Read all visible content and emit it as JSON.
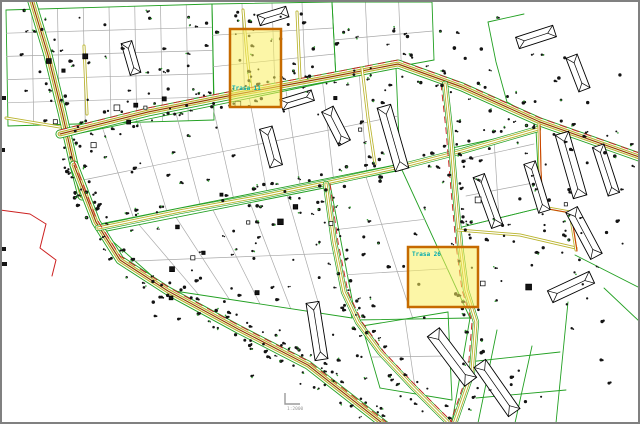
{
  "app": {
    "type": "cad-map-viewport",
    "description": "Cadastral / urban plan drawing with parcels, streets, buildings and tree symbols"
  },
  "map": {
    "highlights": [
      {
        "label": "Trasa 11"
      },
      {
        "label": "Trasa 26"
      }
    ],
    "scale_marker": {
      "text": "1:2000"
    },
    "colors": {
      "background": "#ffffff",
      "frame": "#808080",
      "parcel_line": "#a9a9a9",
      "parcel_dark": "#6e6e6e",
      "boundary_green": "#22a022",
      "road_khaki": "#b9b32c",
      "road_brown": "#964300",
      "road_red": "#cc2020",
      "building_stroke": "#000000",
      "building_fill": "#ffffff",
      "tree_black": "#141414",
      "tree_green": "#2f9e2f",
      "highlight_fill": "#f9ee5e",
      "highlight_border": "#c66a00",
      "highlight_label": "#00aaae",
      "scale_gray": "#9b9b9b"
    }
  }
}
